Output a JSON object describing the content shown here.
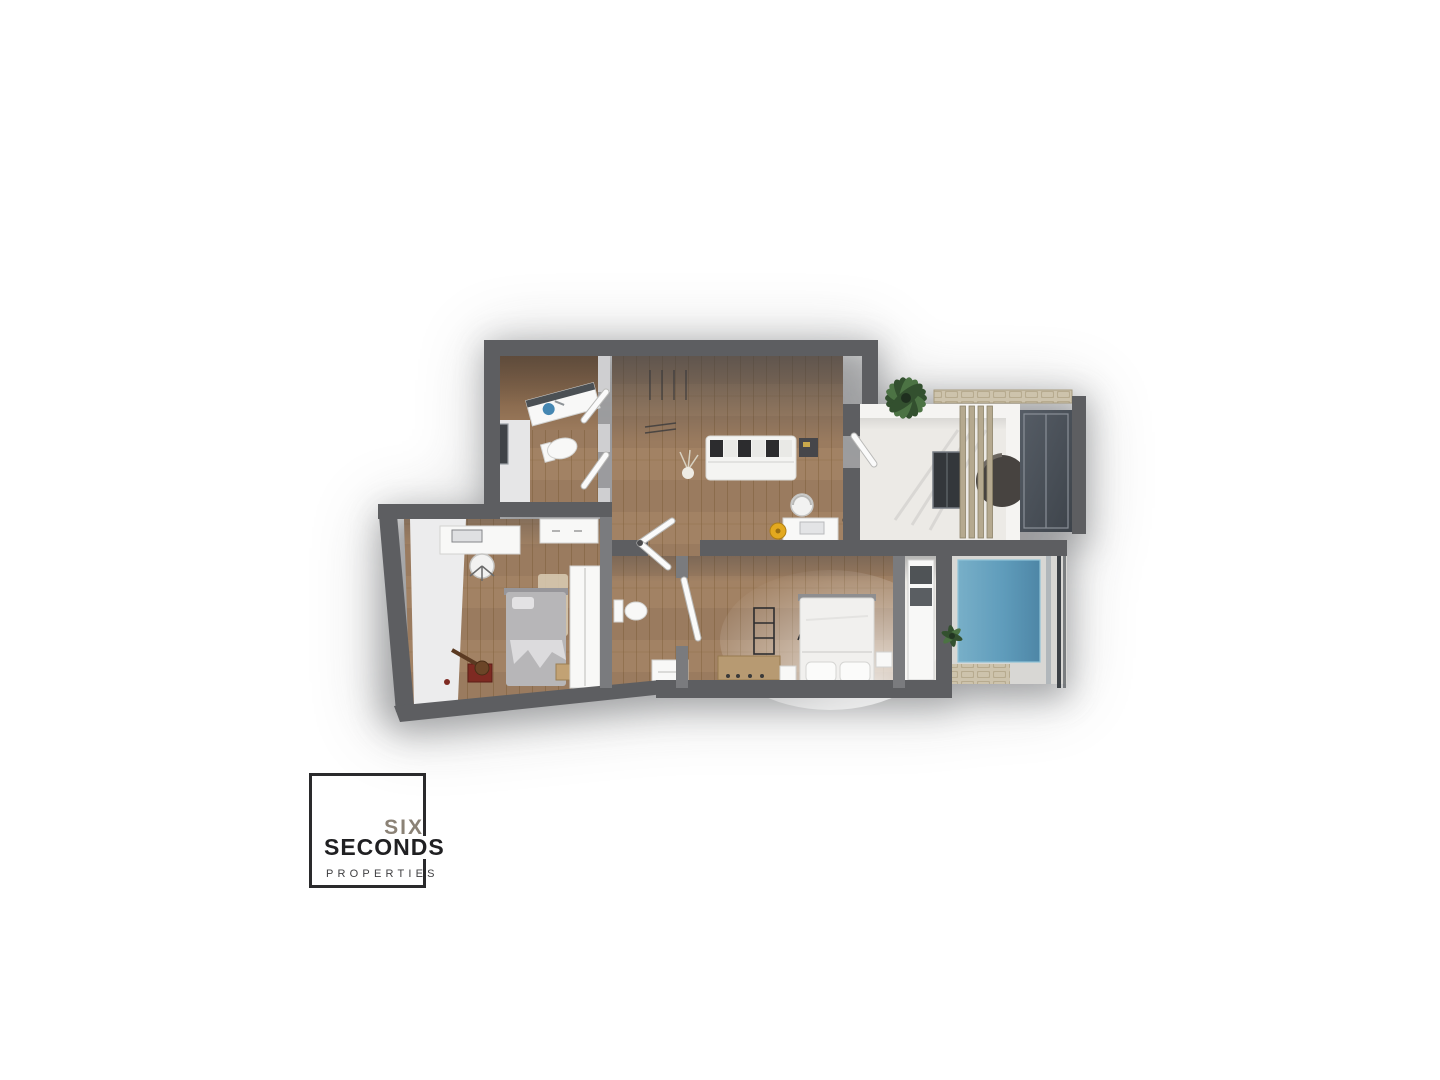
{
  "logo": {
    "line1": "SIX",
    "line2": "SECONDS",
    "line3": "PROPERTIES"
  },
  "colors": {
    "bg": "#ffffff",
    "wall": "#5d5e61",
    "wall-light": "#7a7b7e",
    "partition": "#cfcfd1",
    "inner-face": "#ececed",
    "wood": "#a28264",
    "wood-line": "#85643f",
    "wood-dark": "#6e5138",
    "cream-floor": "#eceae6",
    "deck": "#d8d7d4",
    "pool": "#5f9cbb",
    "pool-deep": "#4e86a6",
    "stone": "#cdc3ac",
    "beam": "#b5a98f",
    "glass": "#3e444b",
    "railing": "#3c4146",
    "sofa": "#f4f4f2",
    "cushion": "#2c2c2e",
    "bed-gray": "#b7b6b8",
    "bed-white": "#f1f0ee",
    "furniture-white": "#f8f8f7",
    "accent-yellow": "#e3a91f",
    "accent-red": "#7e2a22",
    "plant": "#33502f",
    "plant-light": "#4c7344",
    "shadow": "#55565a",
    "logo-border": "#2a2a2c",
    "logo-six": "#8b8276",
    "logo-seconds": "#202022",
    "logo-properties": "#3f3f41"
  }
}
